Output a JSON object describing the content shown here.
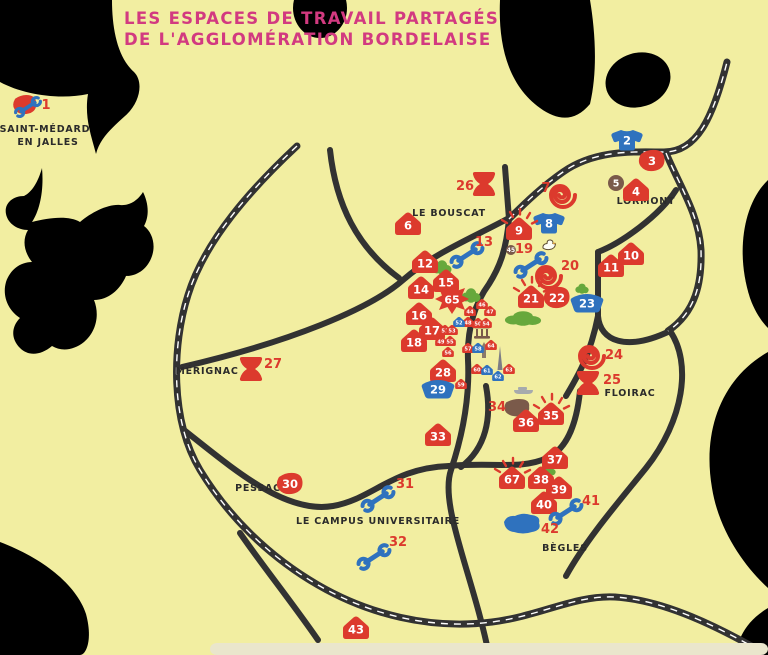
{
  "title": {
    "line1": "LES ESPACES DE TRAVAIL PARTAGÉS",
    "line2": "DE L'AGGLOMÉRATION BORDELAISE"
  },
  "colors": {
    "land": "#F2EEA1",
    "outside": "#FFFFFF",
    "road": "#323232",
    "road_dash": "#FFFFFF",
    "pink": "#D23A80",
    "red": "#DC3A2D",
    "blue": "#2F72BE",
    "green": "#67A83C",
    "brown": "#7A5A4A",
    "ink": "#2B2B2B",
    "gray": "#A6AAAD",
    "strip": "#EAE6CC"
  },
  "places": [
    {
      "name": "SAINT-MÉDARD",
      "x": 45,
      "y": 132
    },
    {
      "name": "EN JALLES",
      "x": 48,
      "y": 145
    },
    {
      "name": "LE BOUSCAT",
      "x": 449,
      "y": 216
    },
    {
      "name": "LORMONT",
      "x": 646,
      "y": 204
    },
    {
      "name": "MÉRIGNAC",
      "x": 207,
      "y": 374
    },
    {
      "name": "FLOIRAC",
      "x": 630,
      "y": 396
    },
    {
      "name": "PESSAC",
      "x": 258,
      "y": 491
    },
    {
      "name": "LE CAMPUS UNIVERSITAIRE",
      "x": 378,
      "y": 524
    },
    {
      "name": "BÈGLES",
      "x": 565,
      "y": 551
    }
  ],
  "markers": [
    {
      "n": "1",
      "t": "combo",
      "x": 25,
      "y": 105,
      "lx": 46,
      "ly": 109
    },
    {
      "n": "2",
      "t": "tshirt",
      "x": 627,
      "y": 140
    },
    {
      "n": "3",
      "t": "blob",
      "x": 652,
      "y": 161
    },
    {
      "n": "4",
      "t": "house",
      "x": 636,
      "y": 190
    },
    {
      "n": "5",
      "t": "dot",
      "x": 616,
      "y": 183
    },
    {
      "n": "6",
      "t": "house",
      "x": 408,
      "y": 224
    },
    {
      "n": "7",
      "t": "spiral",
      "x": 563,
      "y": 195,
      "lx": 546,
      "ly": 192
    },
    {
      "n": "8",
      "t": "tshirt",
      "x": 549,
      "y": 223
    },
    {
      "n": "9",
      "t": "house",
      "x": 519,
      "y": 229,
      "rays": true
    },
    {
      "n": "10",
      "t": "house",
      "x": 631,
      "y": 254
    },
    {
      "n": "11",
      "t": "house",
      "x": 611,
      "y": 266
    },
    {
      "n": "12",
      "t": "house",
      "x": 425,
      "y": 262
    },
    {
      "n": "13",
      "t": "wrench",
      "x": 467,
      "y": 255,
      "lx": 484,
      "ly": 246
    },
    {
      "n": "14",
      "t": "house",
      "x": 421,
      "y": 288
    },
    {
      "n": "15",
      "t": "house",
      "x": 446,
      "y": 281
    },
    {
      "n": "16",
      "t": "house",
      "x": 419,
      "y": 314
    },
    {
      "n": "17",
      "t": "house",
      "x": 432,
      "y": 329
    },
    {
      "n": "18",
      "t": "house",
      "x": 414,
      "y": 341
    },
    {
      "n": "19",
      "t": "wrench",
      "x": 531,
      "y": 265,
      "lx": 524,
      "ly": 253
    },
    {
      "n": "20",
      "t": "spiral",
      "x": 549,
      "y": 276,
      "lx": 570,
      "ly": 270
    },
    {
      "n": "21",
      "t": "house",
      "x": 531,
      "y": 297,
      "rays": true
    },
    {
      "n": "22",
      "t": "blob",
      "x": 557,
      "y": 298
    },
    {
      "n": "23",
      "t": "basin",
      "x": 587,
      "y": 303
    },
    {
      "n": "24",
      "t": "spiral",
      "x": 592,
      "y": 356,
      "lx": 614,
      "ly": 359
    },
    {
      "n": "25",
      "t": "hourglass",
      "x": 588,
      "y": 383,
      "lx": 612,
      "ly": 384
    },
    {
      "n": "26",
      "t": "hourglass",
      "x": 484,
      "y": 184,
      "lx": 465,
      "ly": 190
    },
    {
      "n": "27",
      "t": "hourglass",
      "x": 251,
      "y": 369,
      "lx": 273,
      "ly": 368
    },
    {
      "n": "28",
      "t": "house",
      "x": 443,
      "y": 371
    },
    {
      "n": "29",
      "t": "basin",
      "x": 438,
      "y": 389
    },
    {
      "n": "30",
      "t": "blob",
      "x": 290,
      "y": 484
    },
    {
      "n": "31",
      "t": "wrench",
      "x": 378,
      "y": 499,
      "lx": 405,
      "ly": 488
    },
    {
      "n": "32",
      "t": "wrench",
      "x": 374,
      "y": 557,
      "lx": 398,
      "ly": 546
    },
    {
      "n": "33",
      "t": "house",
      "x": 438,
      "y": 435
    },
    {
      "n": "34",
      "t": "brownblob",
      "x": 517,
      "y": 408,
      "lx": 497,
      "ly": 411
    },
    {
      "n": "35",
      "t": "house",
      "x": 551,
      "y": 414,
      "rays": true
    },
    {
      "n": "36",
      "t": "house",
      "x": 526,
      "y": 421
    },
    {
      "n": "37",
      "t": "house",
      "x": 555,
      "y": 458
    },
    {
      "n": "38",
      "t": "house",
      "x": 541,
      "y": 478
    },
    {
      "n": "39",
      "t": "house",
      "x": 559,
      "y": 488
    },
    {
      "n": "40",
      "t": "house",
      "x": 544,
      "y": 503
    },
    {
      "n": "41",
      "t": "wrench",
      "x": 566,
      "y": 512,
      "lx": 591,
      "ly": 505
    },
    {
      "n": "42",
      "t": "pond",
      "x": 523,
      "y": 524,
      "lx": 550,
      "ly": 533
    },
    {
      "n": "43",
      "t": "house",
      "x": 356,
      "y": 628
    },
    {
      "n": "44",
      "t": "house",
      "s": 0.45,
      "x": 470,
      "y": 311
    },
    {
      "n": "45",
      "t": "dot",
      "s": 0.62,
      "x": 511,
      "y": 250
    },
    {
      "n": "46",
      "t": "house",
      "s": 0.45,
      "x": 482,
      "y": 304
    },
    {
      "n": "47",
      "t": "house",
      "s": 0.45,
      "x": 490,
      "y": 311
    },
    {
      "n": "48",
      "t": "house",
      "s": 0.45,
      "x": 468,
      "y": 322
    },
    {
      "n": "49",
      "t": "house",
      "s": 0.45,
      "x": 441,
      "y": 341
    },
    {
      "n": "50",
      "t": "house",
      "s": 0.45,
      "x": 478,
      "y": 323
    },
    {
      "n": "51",
      "t": "house",
      "s": 0.45,
      "x": 445,
      "y": 330
    },
    {
      "n": "52",
      "t": "house",
      "s": 0.45,
      "x": 459,
      "y": 322,
      "c": "blue"
    },
    {
      "n": "53",
      "t": "house",
      "s": 0.45,
      "x": 452,
      "y": 330
    },
    {
      "n": "54",
      "t": "house",
      "s": 0.45,
      "x": 486,
      "y": 323
    },
    {
      "n": "55",
      "t": "house",
      "s": 0.45,
      "x": 450,
      "y": 341
    },
    {
      "n": "56",
      "t": "house",
      "s": 0.45,
      "x": 448,
      "y": 352
    },
    {
      "n": "57",
      "t": "house",
      "s": 0.45,
      "x": 468,
      "y": 348
    },
    {
      "n": "58",
      "t": "house",
      "s": 0.45,
      "x": 478,
      "y": 348,
      "c": "blue"
    },
    {
      "n": "59",
      "t": "house",
      "s": 0.45,
      "x": 461,
      "y": 384
    },
    {
      "n": "60",
      "t": "house",
      "s": 0.45,
      "x": 477,
      "y": 369
    },
    {
      "n": "61",
      "t": "house",
      "s": 0.45,
      "x": 487,
      "y": 370,
      "c": "blue"
    },
    {
      "n": "62",
      "t": "house",
      "s": 0.45,
      "x": 498,
      "y": 376,
      "c": "blue"
    },
    {
      "n": "63",
      "t": "house",
      "s": 0.45,
      "x": 509,
      "y": 369
    },
    {
      "n": "64",
      "t": "house",
      "s": 0.45,
      "x": 491,
      "y": 345
    },
    {
      "n": "65",
      "t": "burst",
      "x": 452,
      "y": 299
    },
    {
      "n": "67",
      "t": "house",
      "x": 512,
      "y": 478,
      "rays": true
    }
  ],
  "icons": [
    {
      "name": "bush-icon",
      "x": 442,
      "y": 268
    },
    {
      "name": "bush-icon",
      "x": 471,
      "y": 296
    },
    {
      "name": "bush-icon",
      "x": 523,
      "y": 319,
      "wide": true
    },
    {
      "name": "bush-icon",
      "x": 582,
      "y": 289,
      "small": true
    },
    {
      "name": "bush-icon",
      "x": 549,
      "y": 471,
      "small": true
    },
    {
      "name": "duck-icon",
      "x": 549,
      "y": 246
    },
    {
      "name": "monument-icon",
      "x": 482,
      "y": 332
    },
    {
      "name": "church-tower-icon",
      "x": 484,
      "y": 352
    },
    {
      "name": "cathedral-spire-icon",
      "x": 500,
      "y": 360
    },
    {
      "name": "boat-icon",
      "x": 523,
      "y": 390
    }
  ]
}
